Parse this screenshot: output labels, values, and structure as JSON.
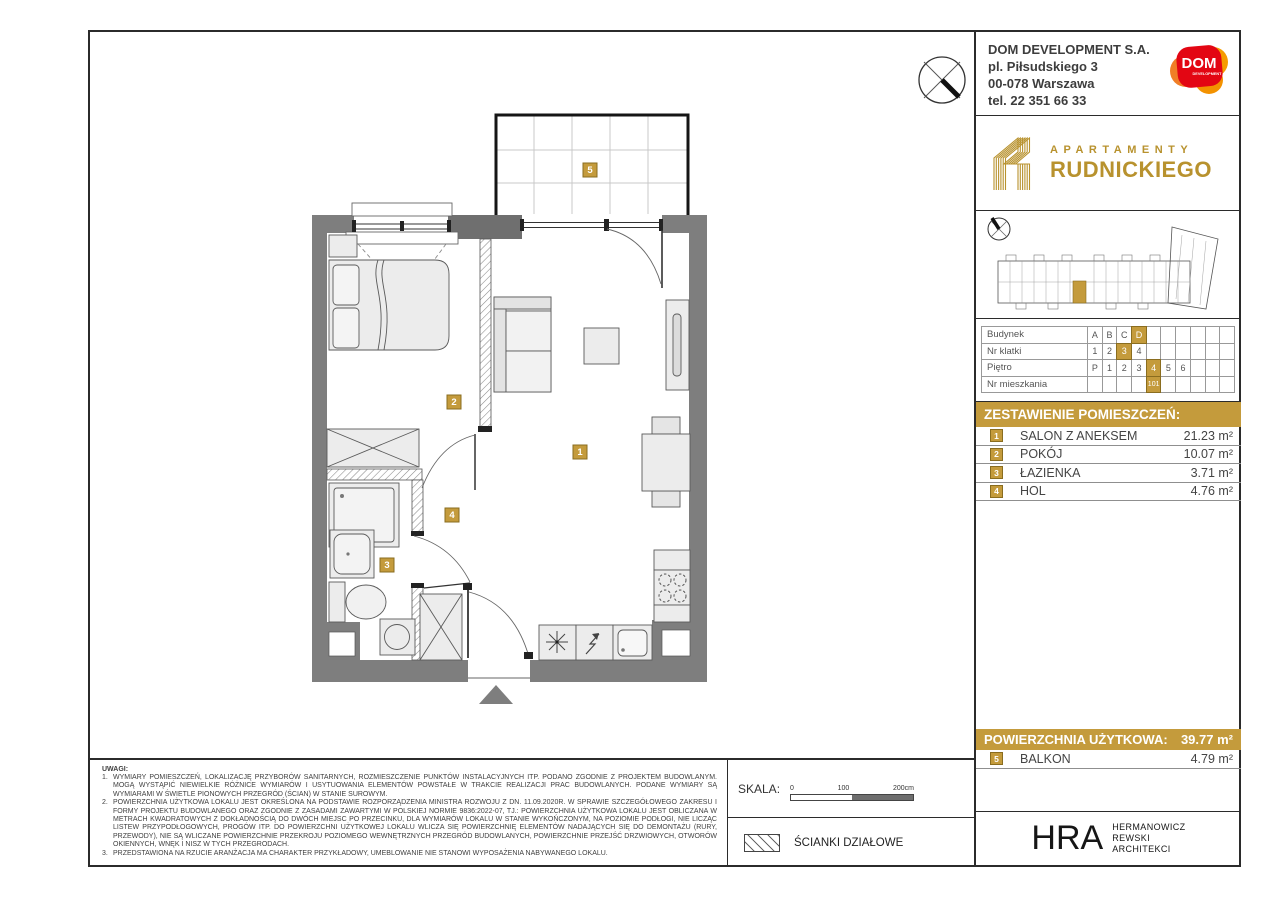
{
  "company": {
    "name": "DOM DEVELOPMENT S.A.",
    "address1": "pl. Piłsudskiego 3",
    "address2": "00-078 Warszawa",
    "phone": "tel. 22 351 66 33"
  },
  "dom_logo": {
    "text": "DOM",
    "sub": "DEVELOPMENT"
  },
  "brand": {
    "top": "APARTAMENTY",
    "bottom": "RUDNICKIEGO"
  },
  "unit_table": {
    "rows": [
      {
        "label": "Budynek",
        "cells": [
          "A",
          "B",
          "C",
          "D",
          "",
          "",
          "",
          "",
          "",
          ""
        ],
        "highlight": 3
      },
      {
        "label": "Nr klatki",
        "cells": [
          "1",
          "2",
          "3",
          "4",
          "",
          "",
          "",
          "",
          "",
          ""
        ],
        "highlight": 2
      },
      {
        "label": "Piętro",
        "cells": [
          "P",
          "1",
          "2",
          "3",
          "4",
          "5",
          "6",
          "",
          "",
          ""
        ],
        "highlight": 4
      },
      {
        "label": "Nr mieszkania",
        "cells": [
          "",
          "",
          "",
          "",
          "101",
          "",
          "",
          "",
          "",
          ""
        ],
        "highlight": 4
      }
    ]
  },
  "rooms": {
    "header": "ZESTAWIENIE POMIESZCZEŃ:",
    "items": [
      {
        "no": "1",
        "name": "SALON Z ANEKSEM",
        "area": "21.23 m²"
      },
      {
        "no": "2",
        "name": "POKÓJ",
        "area": "10.07 m²"
      },
      {
        "no": "3",
        "name": "ŁAZIENKA",
        "area": "3.71 m²"
      },
      {
        "no": "4",
        "name": "HOL",
        "area": "4.76 m²"
      }
    ]
  },
  "summary": {
    "label": "POWIERZCHNIA UŻYTKOWA:",
    "value": "39.77 m²"
  },
  "balcony": {
    "no": "5",
    "name": "BALKON",
    "area": "4.79 m²"
  },
  "plan_labels": {
    "salon": "1",
    "pokoj": "2",
    "lazienka": "3",
    "hol": "4",
    "balkon": "5"
  },
  "notes": {
    "title": "UWAGI:",
    "items": [
      {
        "num": "1.",
        "text": "WYMIARY POMIESZCZEŃ, LOKALIZACJĘ PRZYBORÓW SANITARNYCH, ROZMIESZCZENIE PUNKTÓW INSTALACYJNYCH ITP. PODANO ZGODNIE Z PROJEKTEM BUDOWLANYM. MOGĄ WYSTĄPIĆ NIEWIELKIE RÓŻNICE WYMIARÓW I USYTUOWANIA ELEMENTÓW POWSTAŁE W TRAKCIE REALIZACJI PRAC BUDOWLANYCH. PODANE WYMIARY SĄ WYMIARAMI W ŚWIETLE PIONOWYCH PRZEGRÓD (ŚCIAN) W STANIE SUROWYM."
      },
      {
        "num": "2.",
        "text": "POWIERZCHNIA UŻYTKOWA LOKALU JEST OKREŚLONA NA PODSTAWIE ROZPORZĄDZENIA MINISTRA ROZWOJU Z DN. 11.09.2020R. W SPRAWIE SZCZEGÓŁOWEGO ZAKRESU I FORMY PROJEKTU BUDOWLANEGO ORAZ ZGODNIE Z ZASADAMI ZAWARTYMI W POLSKIEJ NORMIE 9836:2022-07, TJ.: POWIERZCHNIA UŻYTKOWA LOKALU JEST OBLICZANA W METRACH KWADRATOWYCH Z DOKŁADNOŚCIĄ DO DWÓCH MIEJSC PO PRZECINKU, DLA WYMIARÓW LOKALU W STANIE WYKOŃCZONYM, NA POZIOMIE PODŁOGI, NIE LICZĄC LISTEW PRZYPODŁOGOWYCH, PROGÓW ITP. DO POWIERZCHNI UŻYTKOWEJ LOKALU WLICZA SIĘ POWIERZCHNIĘ ELEMENTÓW NADAJĄCYCH SIĘ DO DEMONTAŻU (RURY, PRZEWODY), NIE SĄ WLICZANE POWIERZCHNIE PRZEKROJU POZIOMEGO WEWNĘTRZNYCH PRZEGRÓD BUDOWLANYCH, POWIERZCHNIE PRZEJŚĆ DRZWIOWYCH, OTWORÓW OKIENNYCH, WNĘK I NISZ W TYCH PRZEGRODACH."
      },
      {
        "num": "3.",
        "text": "PRZEDSTAWIONA NA RZUCIE ARANŻACJA MA CHARAKTER PRZYKŁADOWY, UMEBLOWANIE NIE STANOWI WYPOSAŻENIA NABYWANEGO LOKALU."
      }
    ]
  },
  "scale": {
    "label": "SKALA:",
    "ticks": [
      "0",
      "100",
      "200cm"
    ]
  },
  "legend": {
    "label": "ŚCIANKI DZIAŁOWE"
  },
  "architect": {
    "abbr": "HRA",
    "lines": [
      "HERMANOWICZ",
      "REWSKI",
      "ARCHITEKCI"
    ]
  },
  "colors": {
    "gold": "#c49b3c",
    "wall_gray": "#7e7e7e",
    "dom_red": "#e30613",
    "dom_orange": "#f59c00"
  }
}
